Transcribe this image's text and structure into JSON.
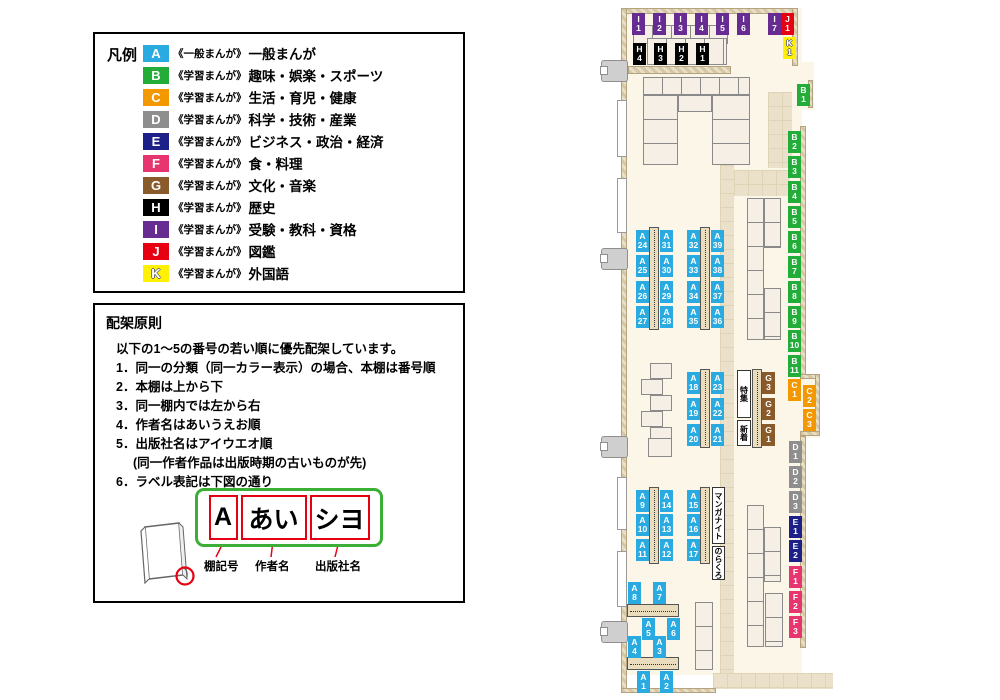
{
  "legend": {
    "title": "凡例",
    "items": [
      {
        "code": "A",
        "color": "#29ABE2",
        "series": "《一般まんが》",
        "category": "一般まんが"
      },
      {
        "code": "B",
        "color": "#22AC38",
        "series": "《学習まんが》",
        "category": "趣味・娯楽・スポーツ"
      },
      {
        "code": "C",
        "color": "#F39800",
        "series": "《学習まんが》",
        "category": "生活・育児・健康"
      },
      {
        "code": "D",
        "color": "#8E8E8E",
        "series": "《学習まんが》",
        "category": "科学・技術・産業"
      },
      {
        "code": "E",
        "color": "#1D2088",
        "series": "《学習まんが》",
        "category": "ビジネス・政治・経済"
      },
      {
        "code": "F",
        "color": "#E73570",
        "series": "《学習まんが》",
        "category": "食・料理"
      },
      {
        "code": "G",
        "color": "#8A5B2A",
        "series": "《学習まんが》",
        "category": "文化・音楽"
      },
      {
        "code": "H",
        "color": "#000000",
        "series": "《学習まんが》",
        "category": "歴史"
      },
      {
        "code": "I",
        "color": "#662C91",
        "series": "《学習まんが》",
        "category": "受験・教科・資格"
      },
      {
        "code": "J",
        "color": "#E60012",
        "series": "《学習まんが》",
        "category": "図鑑"
      },
      {
        "code": "K",
        "color": "#FFF100",
        "series": "《学習まんが》",
        "category": "外国語"
      }
    ]
  },
  "rules": {
    "title": "配架原則",
    "intro": "以下の1〜5の番号の若い順に優先配架しています。",
    "items": [
      {
        "text": "1．同一の分類（同一カラー表示）の場合、本棚は番号順"
      },
      {
        "text": "2．本棚は上から下"
      },
      {
        "text": "3．同一棚内では左から右"
      },
      {
        "text": "4．作者名はあいうえお順"
      },
      {
        "text": "5．出版社名はアイウエオ順"
      },
      {
        "text": "(同一作者作品は出版時期の古いものが先)",
        "indent": true
      },
      {
        "text": "6．ラベル表記は下図の通り"
      }
    ],
    "label_example": {
      "shelf_code": "A",
      "author": "あい",
      "publisher": "シヨ",
      "captions": [
        "棚記号",
        "作者名",
        "出版社名"
      ]
    }
  },
  "map": {
    "colors": {
      "A": "#29ABE2",
      "B": "#22AC38",
      "C": "#F39800",
      "D": "#8E8E8E",
      "E": "#1D2088",
      "F": "#E73570",
      "G": "#8A5B2A",
      "H": "#000000",
      "I": "#662C91",
      "J": "#E60012",
      "K": "#FFF100"
    },
    "labels": [
      {
        "id": "I1",
        "cat": "I",
        "x": 632,
        "y": 13
      },
      {
        "id": "I2",
        "cat": "I",
        "x": 653,
        "y": 13
      },
      {
        "id": "I3",
        "cat": "I",
        "x": 674,
        "y": 13
      },
      {
        "id": "I4",
        "cat": "I",
        "x": 695,
        "y": 13
      },
      {
        "id": "I5",
        "cat": "I",
        "x": 716,
        "y": 13
      },
      {
        "id": "I6",
        "cat": "I",
        "x": 737,
        "y": 13
      },
      {
        "id": "I7",
        "cat": "I",
        "x": 768,
        "y": 13
      },
      {
        "id": "J1",
        "cat": "J",
        "x": 781,
        "y": 13
      },
      {
        "id": "K1",
        "cat": "K",
        "x": 783,
        "y": 37
      },
      {
        "id": "H4",
        "cat": "H",
        "x": 633,
        "y": 43
      },
      {
        "id": "H3",
        "cat": "H",
        "x": 654,
        "y": 43
      },
      {
        "id": "H2",
        "cat": "H",
        "x": 675,
        "y": 43
      },
      {
        "id": "H1",
        "cat": "H",
        "x": 696,
        "y": 43
      },
      {
        "id": "B1",
        "cat": "B",
        "x": 797,
        "y": 84
      },
      {
        "id": "B2",
        "cat": "B",
        "x": 788,
        "y": 131
      },
      {
        "id": "B3",
        "cat": "B",
        "x": 788,
        "y": 156
      },
      {
        "id": "B4",
        "cat": "B",
        "x": 788,
        "y": 181
      },
      {
        "id": "B5",
        "cat": "B",
        "x": 788,
        "y": 206
      },
      {
        "id": "B6",
        "cat": "B",
        "x": 788,
        "y": 231
      },
      {
        "id": "B7",
        "cat": "B",
        "x": 788,
        "y": 256
      },
      {
        "id": "B8",
        "cat": "B",
        "x": 788,
        "y": 281
      },
      {
        "id": "B9",
        "cat": "B",
        "x": 788,
        "y": 306
      },
      {
        "id": "B10",
        "cat": "B",
        "x": 788,
        "y": 330
      },
      {
        "id": "B11",
        "cat": "B",
        "x": 788,
        "y": 355
      },
      {
        "id": "C1",
        "cat": "C",
        "x": 788,
        "y": 379
      },
      {
        "id": "C2",
        "cat": "C",
        "x": 803,
        "y": 385
      },
      {
        "id": "C3",
        "cat": "C",
        "x": 803,
        "y": 409
      },
      {
        "id": "D1",
        "cat": "D",
        "x": 789,
        "y": 441
      },
      {
        "id": "D2",
        "cat": "D",
        "x": 789,
        "y": 466
      },
      {
        "id": "D3",
        "cat": "D",
        "x": 789,
        "y": 491
      },
      {
        "id": "E1",
        "cat": "E",
        "x": 789,
        "y": 516
      },
      {
        "id": "E2",
        "cat": "E",
        "x": 789,
        "y": 540
      },
      {
        "id": "F1",
        "cat": "F",
        "x": 789,
        "y": 566
      },
      {
        "id": "F2",
        "cat": "F",
        "x": 789,
        "y": 591
      },
      {
        "id": "F3",
        "cat": "F",
        "x": 789,
        "y": 616
      },
      {
        "id": "A24",
        "cat": "A",
        "x": 636,
        "y": 230
      },
      {
        "id": "A25",
        "cat": "A",
        "x": 636,
        "y": 255
      },
      {
        "id": "A26",
        "cat": "A",
        "x": 636,
        "y": 281
      },
      {
        "id": "A27",
        "cat": "A",
        "x": 636,
        "y": 306
      },
      {
        "id": "A31",
        "cat": "A",
        "x": 660,
        "y": 230
      },
      {
        "id": "A30",
        "cat": "A",
        "x": 660,
        "y": 255
      },
      {
        "id": "A29",
        "cat": "A",
        "x": 660,
        "y": 281
      },
      {
        "id": "A28",
        "cat": "A",
        "x": 660,
        "y": 306
      },
      {
        "id": "A32",
        "cat": "A",
        "x": 687,
        "y": 230
      },
      {
        "id": "A33",
        "cat": "A",
        "x": 687,
        "y": 255
      },
      {
        "id": "A34",
        "cat": "A",
        "x": 687,
        "y": 281
      },
      {
        "id": "A35",
        "cat": "A",
        "x": 687,
        "y": 306
      },
      {
        "id": "A39",
        "cat": "A",
        "x": 711,
        "y": 230
      },
      {
        "id": "A38",
        "cat": "A",
        "x": 711,
        "y": 255
      },
      {
        "id": "A37",
        "cat": "A",
        "x": 711,
        "y": 281
      },
      {
        "id": "A36",
        "cat": "A",
        "x": 711,
        "y": 306
      },
      {
        "id": "A18",
        "cat": "A",
        "x": 687,
        "y": 372
      },
      {
        "id": "A19",
        "cat": "A",
        "x": 687,
        "y": 398
      },
      {
        "id": "A20",
        "cat": "A",
        "x": 687,
        "y": 424
      },
      {
        "id": "A23",
        "cat": "A",
        "x": 711,
        "y": 372
      },
      {
        "id": "A22",
        "cat": "A",
        "x": 711,
        "y": 398
      },
      {
        "id": "A21",
        "cat": "A",
        "x": 711,
        "y": 424
      },
      {
        "id": "G3",
        "cat": "G",
        "x": 762,
        "y": 372
      },
      {
        "id": "G2",
        "cat": "G",
        "x": 762,
        "y": 398
      },
      {
        "id": "G1",
        "cat": "G",
        "x": 762,
        "y": 424
      },
      {
        "id": "A9",
        "cat": "A",
        "x": 636,
        "y": 490
      },
      {
        "id": "A10",
        "cat": "A",
        "x": 636,
        "y": 514
      },
      {
        "id": "A11",
        "cat": "A",
        "x": 636,
        "y": 539
      },
      {
        "id": "A14",
        "cat": "A",
        "x": 660,
        "y": 490
      },
      {
        "id": "A13",
        "cat": "A",
        "x": 660,
        "y": 514
      },
      {
        "id": "A12",
        "cat": "A",
        "x": 660,
        "y": 539
      },
      {
        "id": "A15",
        "cat": "A",
        "x": 687,
        "y": 490
      },
      {
        "id": "A16",
        "cat": "A",
        "x": 687,
        "y": 514
      },
      {
        "id": "A17",
        "cat": "A",
        "x": 687,
        "y": 539
      },
      {
        "id": "A8",
        "cat": "A",
        "x": 628,
        "y": 582
      },
      {
        "id": "A7",
        "cat": "A",
        "x": 653,
        "y": 582
      },
      {
        "id": "A5",
        "cat": "A",
        "x": 642,
        "y": 618
      },
      {
        "id": "A6",
        "cat": "A",
        "x": 667,
        "y": 618
      },
      {
        "id": "A4",
        "cat": "A",
        "x": 628,
        "y": 636
      },
      {
        "id": "A3",
        "cat": "A",
        "x": 653,
        "y": 636
      },
      {
        "id": "A1",
        "cat": "A",
        "x": 637,
        "y": 671
      },
      {
        "id": "A2",
        "cat": "A",
        "x": 660,
        "y": 671
      }
    ],
    "notes": [
      {
        "text": "特集",
        "x": 737,
        "y": 370,
        "w": 14,
        "h": 48
      },
      {
        "text": "新着",
        "x": 737,
        "y": 420,
        "w": 14,
        "h": 26
      },
      {
        "text": "マンガナイト",
        "x": 712,
        "y": 487,
        "w": 13,
        "h": 57
      },
      {
        "text": "のらくろ",
        "x": 712,
        "y": 546,
        "w": 13,
        "h": 34
      }
    ]
  }
}
